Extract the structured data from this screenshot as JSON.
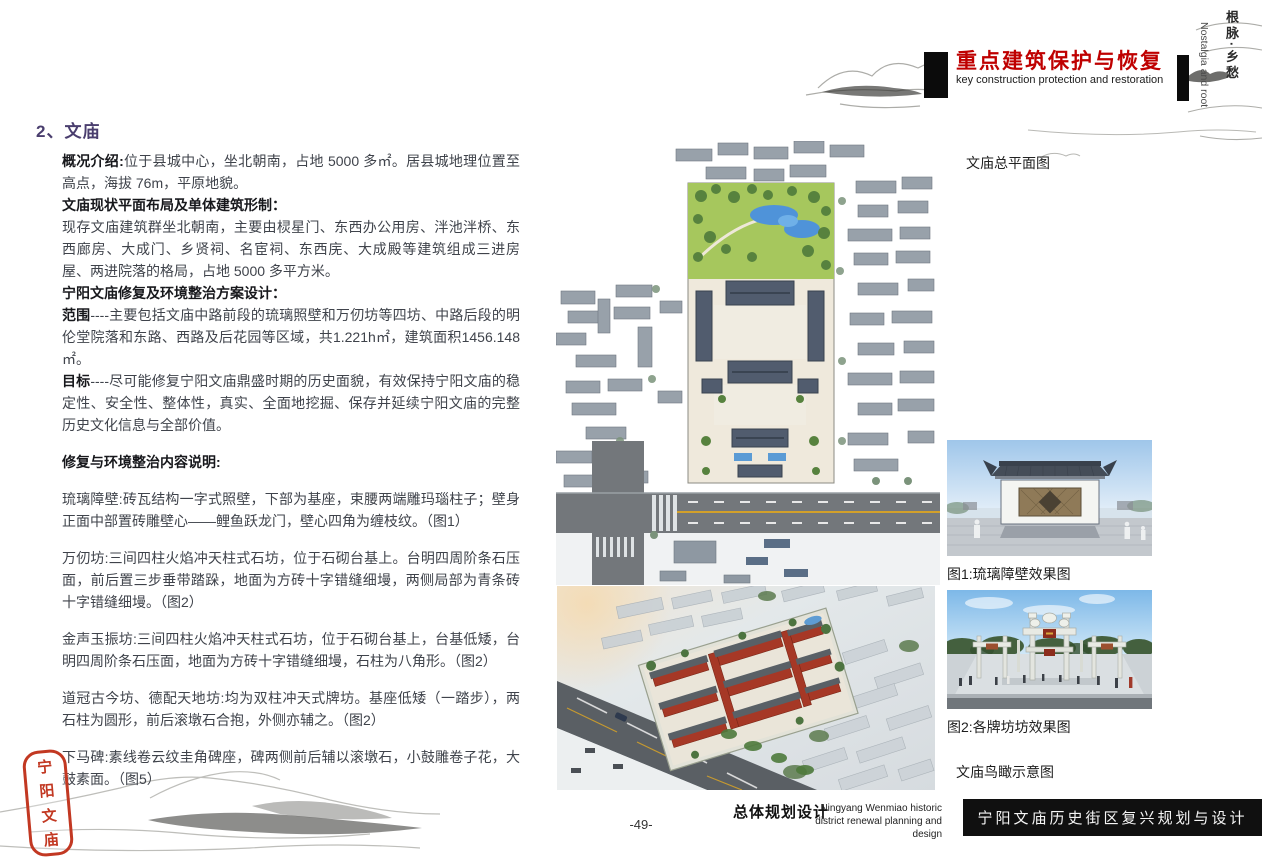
{
  "header": {
    "title": "重点建筑保护与恢复",
    "subtitle": "key construction  protection and restoration",
    "corner_cn": "根脉·乡愁",
    "corner_en": "Nostalgia and root",
    "accent_red": "#bf0000"
  },
  "section": {
    "heading": "2、文庙"
  },
  "paragraphs": [
    {
      "lead": "概况介绍:",
      "text": "位于县城中心，坐北朝南，占地 5000 多㎡。居县城地理位置至高点，海拔 76m，平原地貌。",
      "gap": false
    },
    {
      "lead": "文庙现状平面布局及单体建筑形制：",
      "text": "",
      "gap": false
    },
    {
      "lead": "",
      "text": "现存文庙建筑群坐北朝南，主要由棂星门、东西办公用房、泮池泮桥、东西廊房、大成门、乡贤祠、名宦祠、东西庑、大成殿等建筑组成三进房屋、两进院落的格局，占地 5000 多平方米。",
      "gap": false
    },
    {
      "lead": "宁阳文庙修复及环境整治方案设计：",
      "text": "",
      "gap": false
    },
    {
      "lead": "范围",
      "text": "----主要包括文庙中路前段的琉璃照壁和万仞坊等四坊、中路后段的明伦堂院落和东路、西路及后花园等区域，共1.221h㎡，建筑面积1456.148㎡。",
      "gap": false
    },
    {
      "lead": "目标",
      "text": "----尽可能修复宁阳文庙鼎盛时期的历史面貌，有效保持宁阳文庙的稳定性、安全性、整体性，真实、全面地挖掘、保存并延续宁阳文庙的完整历史文化信息与全部价值。",
      "gap": false
    },
    {
      "lead": "修复与环境整治内容说明:",
      "text": "",
      "gap": true
    },
    {
      "lead": "",
      "text": "琉璃障壁:砖瓦结构一字式照壁，下部为基座，束腰两端雕玛瑙柱子；壁身正面中部置砖雕壁心——鲤鱼跃龙门，壁心四角为缠枝纹。（图1）",
      "gap": true
    },
    {
      "lead": "",
      "text": "万仞坊:三间四柱火焰冲天柱式石坊，位于石砌台基上。台明四周阶条石压面，前后置三步垂带踏跺，地面为方砖十字错缝细墁，两侧局部为青条砖十字错缝细墁。（图2）",
      "gap": true
    },
    {
      "lead": "",
      "text": "金声玉振坊:三间四柱火焰冲天柱式石坊，位于石砌台基上，台基低矮，台明四周阶条石压面，地面为方砖十字错缝细墁，石柱为八角形。（图2）",
      "gap": true
    },
    {
      "lead": "",
      "text": "道冠古今坊、德配天地坊:均为双柱冲天式牌坊。基座低矮（一踏步），两石柱为圆形，前后滚墩石合抱，外侧亦辅之。（图2）",
      "gap": true
    },
    {
      "lead": "",
      "text": "下马碑:素线卷云纹圭角碑座，碑两侧前后辅以滚墩石，小鼓雕卷子花，大鼓素面。（图5）",
      "gap": true
    }
  ],
  "labels": {
    "plan": "文庙总平面图",
    "aerial": "文庙鸟瞰示意图"
  },
  "figures": [
    {
      "caption": "图1:琉璃障壁效果图"
    },
    {
      "caption": "图2:各牌坊坊效果图"
    }
  ],
  "seal_chars": [
    "宁",
    "阳",
    "文",
    "庙"
  ],
  "footer": {
    "page": "-49-",
    "cn_bold": "总体规划设计",
    "en_line1": "Ningyang Wenmiao historic",
    "en_line2": "district  renewal  planning  and  design",
    "bar_text": "宁阳文庙历史街区复兴规划与设计"
  }
}
